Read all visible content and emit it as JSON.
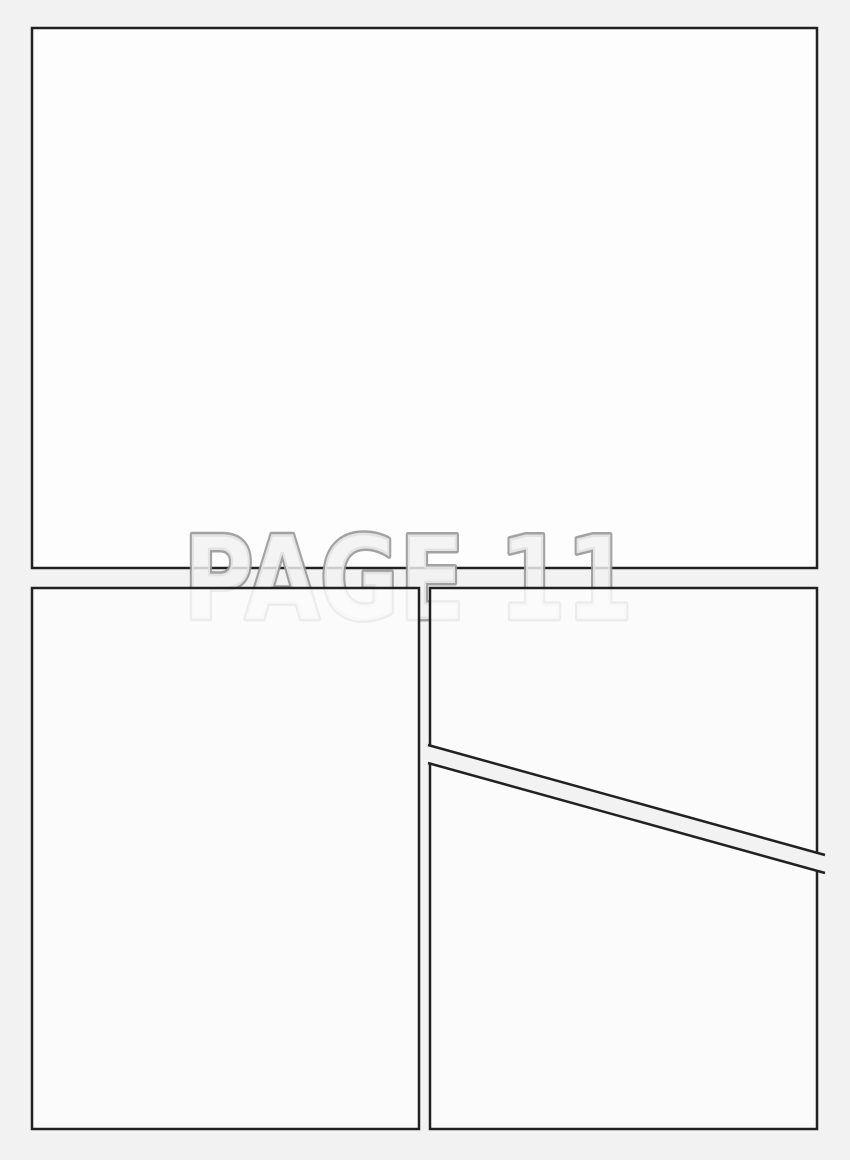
{
  "page_label": "PAGE 11",
  "colors": {
    "background": "#f2f2f2",
    "panel_fill": "#fdfdfd",
    "panel_border": "#212121",
    "label_fill": "#f2f2f2",
    "label_outline": "#989898"
  },
  "panels": [
    {
      "id": "panel-top",
      "shape": "rectangle",
      "position": "top, full width"
    },
    {
      "id": "panel-bottom-left",
      "shape": "rectangle",
      "position": "bottom left"
    },
    {
      "id": "panel-top-right",
      "shape": "quadrilateral, slanted bottom edge",
      "position": "middle right"
    },
    {
      "id": "panel-bottom-right",
      "shape": "quadrilateral, slanted top edge",
      "position": "bottom right"
    }
  ]
}
